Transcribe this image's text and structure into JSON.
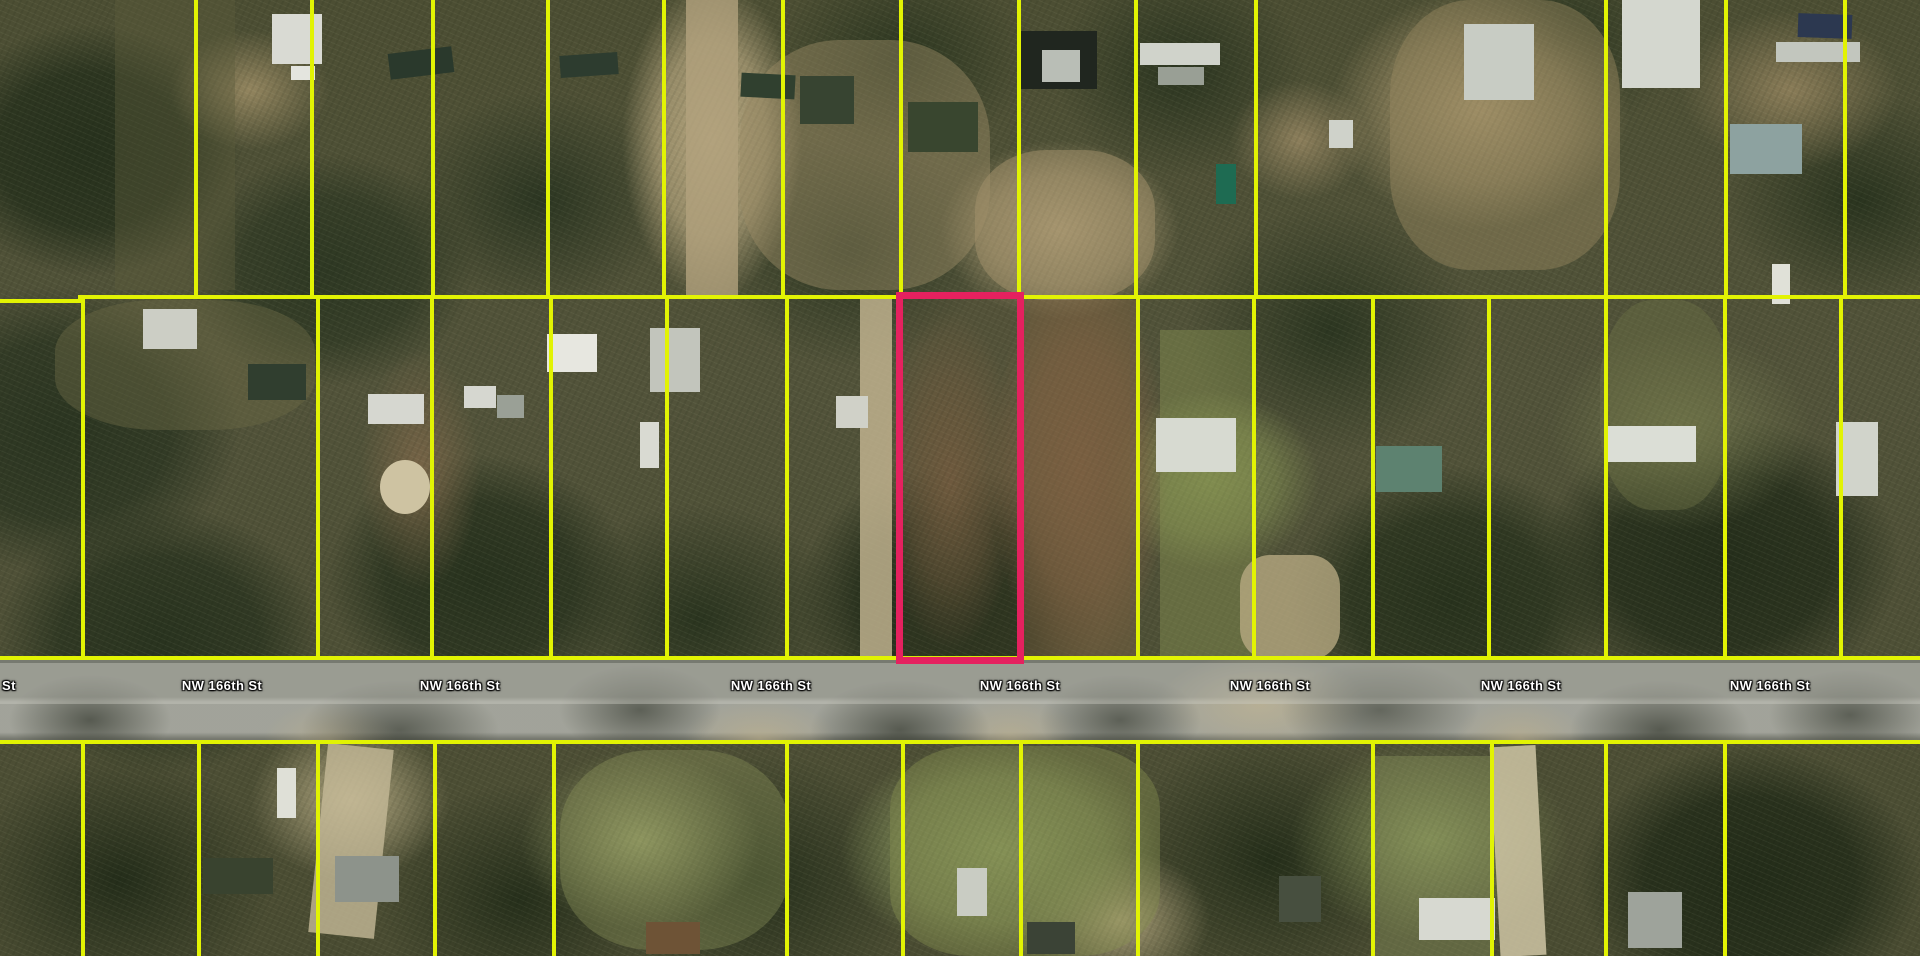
{
  "map": {
    "road": {
      "label": "NW 166th St",
      "partial_label_left": "St",
      "band": {
        "top": 660,
        "bottom": 744,
        "label_band_top": 663,
        "label_band_bottom": 704,
        "label_text_y": 678
      },
      "label_centers_x": [
        222,
        460,
        771,
        1020,
        1270,
        1521,
        1770
      ],
      "partial_label_x": 2
    },
    "parcels": {
      "line_color": "#e2f303",
      "line_width": 4,
      "highlight_color": "#e5215f",
      "highlight_border_width": 7,
      "h_lines": [
        {
          "x": 0,
          "w": 82,
          "y": 299
        },
        {
          "x": 78,
          "w": 1842,
          "y": 295
        },
        {
          "x": 0,
          "w": 1920,
          "y": 656
        },
        {
          "x": 0,
          "w": 1920,
          "y": 740
        }
      ],
      "top_row": {
        "y1": 0,
        "y2": 299,
        "xs": [
          196,
          312,
          433,
          548,
          664,
          783,
          901,
          1019,
          1136,
          1256,
          1606,
          1726,
          1845
        ]
      },
      "mid_row": {
        "y1": 299,
        "y2": 660,
        "xs": [
          83,
          318,
          432,
          551,
          667,
          787,
          1138,
          1254,
          1373,
          1489,
          1606,
          1725,
          1841
        ]
      },
      "bottom_row": {
        "y1": 744,
        "y2": 956,
        "xs": [
          83,
          199,
          318,
          435,
          554,
          787,
          903,
          1021,
          1138,
          1373,
          1492,
          1606,
          1725
        ]
      },
      "highlight": {
        "x": 896,
        "y": 292,
        "w": 128,
        "h": 372
      }
    },
    "features": [
      {
        "n": "terrain-patch",
        "x": 115,
        "y": 0,
        "w": 120,
        "h": 290,
        "c": "#5d5c3c",
        "o": 0.4
      },
      {
        "n": "terrain-patch",
        "x": 55,
        "y": 300,
        "w": 260,
        "h": 130,
        "c": "#6b6845",
        "o": 0.45,
        "br": "40%"
      },
      {
        "n": "driveway",
        "x": 686,
        "y": 0,
        "w": 52,
        "h": 298,
        "c": "#b2a17d",
        "o": 0.8
      },
      {
        "n": "terrain-patch",
        "x": 740,
        "y": 40,
        "w": 250,
        "h": 250,
        "c": "#9c8c66",
        "o": 0.45,
        "br": "40%"
      },
      {
        "n": "terrain-patch",
        "x": 975,
        "y": 150,
        "w": 180,
        "h": 150,
        "c": "#a3926c",
        "o": 0.5,
        "br": "40%"
      },
      {
        "n": "terrain-patch",
        "x": 1390,
        "y": 0,
        "w": 230,
        "h": 270,
        "c": "#97875f",
        "o": 0.45,
        "br": "35%"
      },
      {
        "n": "terrain-patch",
        "x": 1600,
        "y": 300,
        "w": 130,
        "h": 210,
        "c": "#6d7247",
        "o": 0.4,
        "br": "40%"
      },
      {
        "n": "driveway",
        "x": 860,
        "y": 298,
        "w": 32,
        "h": 362,
        "c": "#c7b894",
        "o": 0.8
      },
      {
        "n": "terrain-patch",
        "x": 1020,
        "y": 300,
        "w": 116,
        "h": 360,
        "c": "#77603f",
        "o": 0.5
      },
      {
        "n": "terrain-patch",
        "x": 1160,
        "y": 330,
        "w": 92,
        "h": 330,
        "c": "#86914f",
        "o": 0.45
      },
      {
        "n": "terrain-patch",
        "x": 1240,
        "y": 555,
        "w": 100,
        "h": 105,
        "c": "#bcae86",
        "o": 0.75,
        "br": "30%"
      },
      {
        "n": "driveway",
        "x": 1495,
        "y": 746,
        "w": 46,
        "h": 210,
        "c": "#cfc5a4",
        "o": 0.85,
        "r": -3
      },
      {
        "n": "driveway",
        "x": 318,
        "y": 746,
        "w": 66,
        "h": 190,
        "c": "#c4b997",
        "o": 0.8,
        "r": 6
      },
      {
        "n": "terrain-patch",
        "x": 560,
        "y": 750,
        "w": 230,
        "h": 200,
        "c": "#929a5e",
        "o": 0.35,
        "br": "40%"
      },
      {
        "n": "terrain-patch",
        "x": 890,
        "y": 746,
        "w": 270,
        "h": 210,
        "c": "#87914f",
        "o": 0.4,
        "br": "30%"
      },
      {
        "n": "terrain-patch",
        "x": 1373,
        "y": 756,
        "w": 118,
        "h": 200,
        "c": "#8a935c",
        "o": 0.4
      },
      {
        "n": "structure-roof",
        "x": 272,
        "y": 14,
        "w": 50,
        "h": 50,
        "c": "#d9dad3"
      },
      {
        "n": "structure-roof",
        "x": 291,
        "y": 66,
        "w": 24,
        "h": 14,
        "c": "#e4e5df"
      },
      {
        "n": "structure-roof",
        "x": 389,
        "y": 50,
        "w": 64,
        "h": 26,
        "c": "#2a392c",
        "r": -7
      },
      {
        "n": "structure-roof",
        "x": 560,
        "y": 54,
        "w": 58,
        "h": 22,
        "c": "#2d3c2f",
        "r": -4
      },
      {
        "n": "structure-roof",
        "x": 741,
        "y": 74,
        "w": 54,
        "h": 24,
        "c": "#30402f",
        "r": 3
      },
      {
        "n": "structure-roof",
        "x": 800,
        "y": 76,
        "w": 54,
        "h": 48,
        "c": "#374431"
      },
      {
        "n": "structure-roof",
        "x": 908,
        "y": 102,
        "w": 70,
        "h": 50,
        "c": "#39462f"
      },
      {
        "n": "structure-roof",
        "x": 1019,
        "y": 31,
        "w": 78,
        "h": 58,
        "c": "#20261f"
      },
      {
        "n": "structure-roof",
        "x": 1042,
        "y": 50,
        "w": 38,
        "h": 32,
        "c": "#b9beb6"
      },
      {
        "n": "structure-roof",
        "x": 1140,
        "y": 43,
        "w": 80,
        "h": 22,
        "c": "#d0d3cb"
      },
      {
        "n": "structure-roof",
        "x": 1158,
        "y": 67,
        "w": 46,
        "h": 18,
        "c": "#999f95"
      },
      {
        "n": "structure-roof",
        "x": 1216,
        "y": 164,
        "w": 20,
        "h": 40,
        "c": "#1e6b52"
      },
      {
        "n": "structure-roof",
        "x": 1464,
        "y": 24,
        "w": 70,
        "h": 76,
        "c": "#c8ccc4"
      },
      {
        "n": "structure-roof",
        "x": 1622,
        "y": 0,
        "w": 78,
        "h": 88,
        "c": "#d4d7cf"
      },
      {
        "n": "vehicle",
        "x": 1798,
        "y": 14,
        "w": 54,
        "h": 24,
        "c": "#2c3850",
        "r": 2
      },
      {
        "n": "structure-roof",
        "x": 1776,
        "y": 42,
        "w": 84,
        "h": 20,
        "c": "#c2c6be"
      },
      {
        "n": "structure-roof",
        "x": 1730,
        "y": 124,
        "w": 72,
        "h": 50,
        "c": "#8da2a0"
      },
      {
        "n": "vehicle",
        "x": 1329,
        "y": 120,
        "w": 24,
        "h": 28,
        "c": "#cfd2ca"
      },
      {
        "n": "structure-roof",
        "x": 143,
        "y": 309,
        "w": 54,
        "h": 40,
        "c": "#cccec5"
      },
      {
        "n": "structure-roof",
        "x": 248,
        "y": 364,
        "w": 58,
        "h": 36,
        "c": "#303e2f"
      },
      {
        "n": "structure-roof",
        "x": 368,
        "y": 394,
        "w": 56,
        "h": 30,
        "c": "#d6d7d0"
      },
      {
        "n": "terrain-patch",
        "x": 380,
        "y": 460,
        "w": 50,
        "h": 54,
        "c": "#cec3a2",
        "br": "50%"
      },
      {
        "n": "structure-roof",
        "x": 464,
        "y": 386,
        "w": 32,
        "h": 22,
        "c": "#d6d7d0"
      },
      {
        "n": "structure-roof",
        "x": 497,
        "y": 395,
        "w": 27,
        "h": 23,
        "c": "#9aa096"
      },
      {
        "n": "structure-roof",
        "x": 547,
        "y": 334,
        "w": 50,
        "h": 38,
        "c": "#e7e7e0"
      },
      {
        "n": "structure-roof",
        "x": 650,
        "y": 328,
        "w": 50,
        "h": 64,
        "c": "#c2c5bc"
      },
      {
        "n": "vehicle",
        "x": 640,
        "y": 422,
        "w": 19,
        "h": 46,
        "c": "#d9dad2"
      },
      {
        "n": "structure-roof",
        "x": 836,
        "y": 396,
        "w": 32,
        "h": 32,
        "c": "#d0d1c8"
      },
      {
        "n": "structure-roof",
        "x": 1156,
        "y": 418,
        "w": 80,
        "h": 54,
        "c": "#d7dad1"
      },
      {
        "n": "structure-roof",
        "x": 1376,
        "y": 446,
        "w": 66,
        "h": 46,
        "c": "#5d8270"
      },
      {
        "n": "structure-roof",
        "x": 1608,
        "y": 426,
        "w": 88,
        "h": 36,
        "c": "#dbded6"
      },
      {
        "n": "structure-roof",
        "x": 1836,
        "y": 422,
        "w": 42,
        "h": 74,
        "c": "#d1d4cb"
      },
      {
        "n": "vehicle",
        "x": 1772,
        "y": 264,
        "w": 18,
        "h": 40,
        "c": "#e0e1d8"
      },
      {
        "n": "vehicle",
        "x": 277,
        "y": 768,
        "w": 19,
        "h": 50,
        "c": "#dfe0d7"
      },
      {
        "n": "structure-roof",
        "x": 203,
        "y": 858,
        "w": 70,
        "h": 36,
        "c": "#39432f"
      },
      {
        "n": "structure-roof",
        "x": 335,
        "y": 856,
        "w": 64,
        "h": 46,
        "c": "#8d938b"
      },
      {
        "n": "structure-roof",
        "x": 646,
        "y": 922,
        "w": 54,
        "h": 32,
        "c": "#6e5336"
      },
      {
        "n": "structure-roof",
        "x": 957,
        "y": 868,
        "w": 30,
        "h": 48,
        "c": "#c9ccc3"
      },
      {
        "n": "structure-roof",
        "x": 1027,
        "y": 922,
        "w": 48,
        "h": 32,
        "c": "#3b4336"
      },
      {
        "n": "structure-roof",
        "x": 1279,
        "y": 876,
        "w": 42,
        "h": 46,
        "c": "#474f3f"
      },
      {
        "n": "structure-roof",
        "x": 1419,
        "y": 898,
        "w": 76,
        "h": 42,
        "c": "#d7d9d1"
      },
      {
        "n": "structure-roof",
        "x": 1628,
        "y": 892,
        "w": 54,
        "h": 56,
        "c": "#9ea39b"
      }
    ]
  }
}
